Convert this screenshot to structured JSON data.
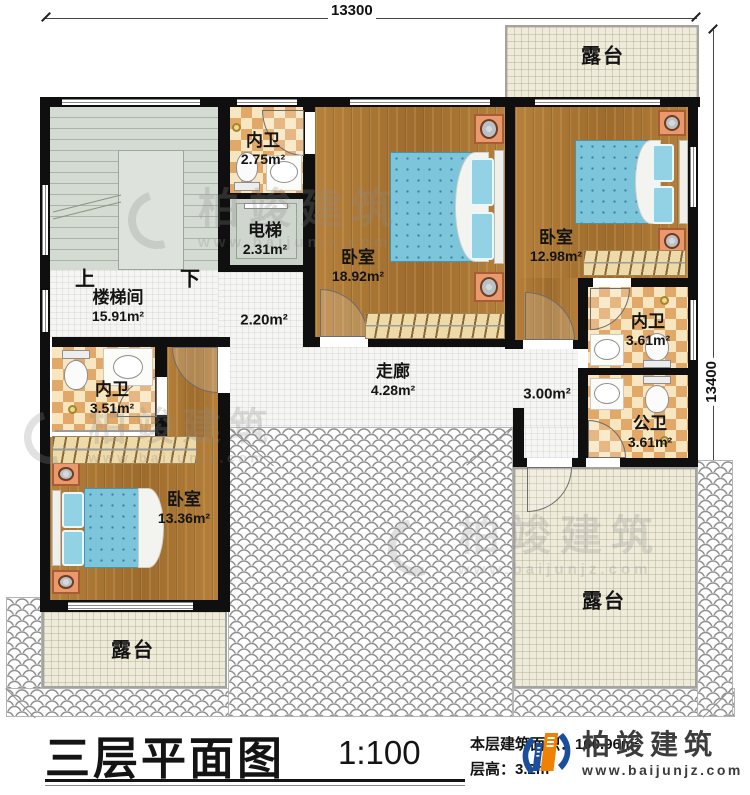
{
  "dimensions": {
    "top": "13300",
    "right": "13400"
  },
  "rooms": {
    "terrace_top": {
      "name": "露台"
    },
    "terrace_bottom_left": {
      "name": "露台"
    },
    "terrace_bottom_right": {
      "name": "露台"
    },
    "bath_top": {
      "name": "内卫",
      "area": "2.75m²"
    },
    "elevator": {
      "name": "电梯",
      "area": "2.31m²"
    },
    "bedroom_center": {
      "name": "卧室",
      "area": "18.92m²"
    },
    "bedroom_right": {
      "name": "卧室",
      "area": "12.98m²"
    },
    "stairwell": {
      "name": "楼梯间",
      "area": "15.91m²"
    },
    "bath_right": {
      "name": "内卫",
      "area": "3.61m²"
    },
    "bath_public": {
      "name": "公卫",
      "area": "3.61m²"
    },
    "corridor": {
      "name": "走廊",
      "area": "4.28m²"
    },
    "bath_left": {
      "name": "内卫",
      "area": "3.51m²"
    },
    "bedroom_bottom_left": {
      "name": "卧室",
      "area": "13.36m²"
    },
    "hall_small": {
      "area": "2.20m²"
    },
    "hall_right": {
      "area": "3.00m²"
    }
  },
  "stairs": {
    "up": "上",
    "down": "下"
  },
  "title": {
    "main": "三层平面图",
    "scale": "1:100",
    "area_label": "本层建筑面积：",
    "area_value": "100.96m²",
    "floor_height_label": "层高：",
    "floor_height_value": "3.2m"
  },
  "logo": {
    "name": "柏竣建筑",
    "url": "www.baijunjz.com"
  },
  "watermark": {
    "text": "柏竣建筑",
    "url": "www.baijunjz.com"
  },
  "colors": {
    "wall": "#0f0f0f",
    "wood": "#a9752f",
    "checker_dark": "#e2a868",
    "checker_light": "#f7e6bf",
    "terrace": "#eeebdb",
    "stair": "#d4dbd3",
    "bed": "#7cc5da",
    "logo_blue": "#1b4f9c",
    "logo_orange": "#ef8200"
  }
}
